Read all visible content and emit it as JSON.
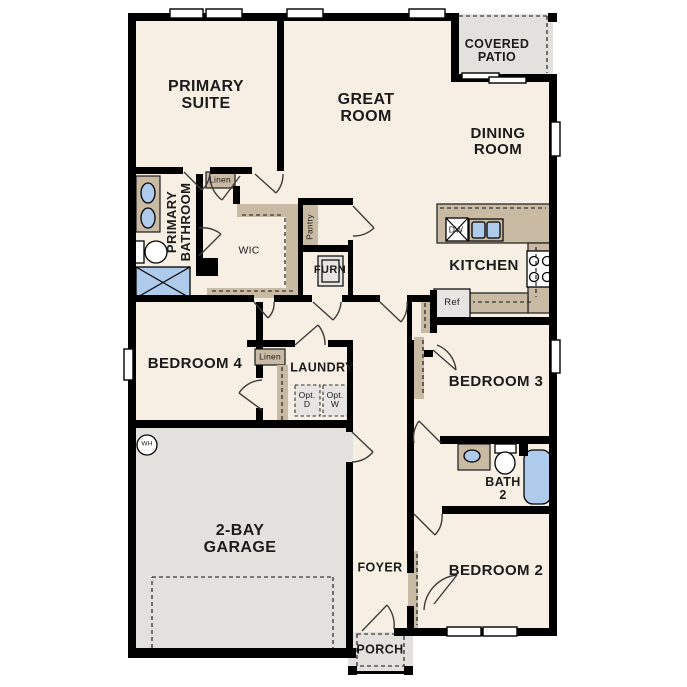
{
  "floorplan": {
    "rooms": {
      "primary_suite": "PRIMARY\nSUITE",
      "great_room": "GREAT\nROOM",
      "covered_patio": "COVERED\nPATIO",
      "dining_room": "DINING\nROOM",
      "primary_bathroom": "PRIMARY\nBATHROOM",
      "wic": "WIC",
      "linen_upper": "Linen",
      "pantry": "Pantry",
      "furnace_closet": "FURN",
      "kitchen": "KITCHEN",
      "bedroom_4": "BEDROOM 4",
      "linen_hall": "Linen",
      "laundry": "LAUNDRY",
      "optional_dryer": "Opt.\nD",
      "optional_washer": "Opt.\nW",
      "bedroom_3": "BEDROOM 3",
      "bath_2": "BATH\n2",
      "bedroom_2": "BEDROOM 2",
      "garage": "2-BAY\nGARAGE",
      "foyer": "FOYER",
      "porch": "PORCH"
    },
    "appliances": {
      "dishwasher": "DW",
      "refrigerator": "Ref",
      "water_heater": "WH"
    },
    "colors": {
      "floor": "#f7efe3",
      "outdoor": "#e2e1de",
      "cabinet": "#c9bba3",
      "fixture_blue": "#aecbec",
      "wall": "#000000",
      "appliance_gray": "#e6e5e3"
    }
  }
}
